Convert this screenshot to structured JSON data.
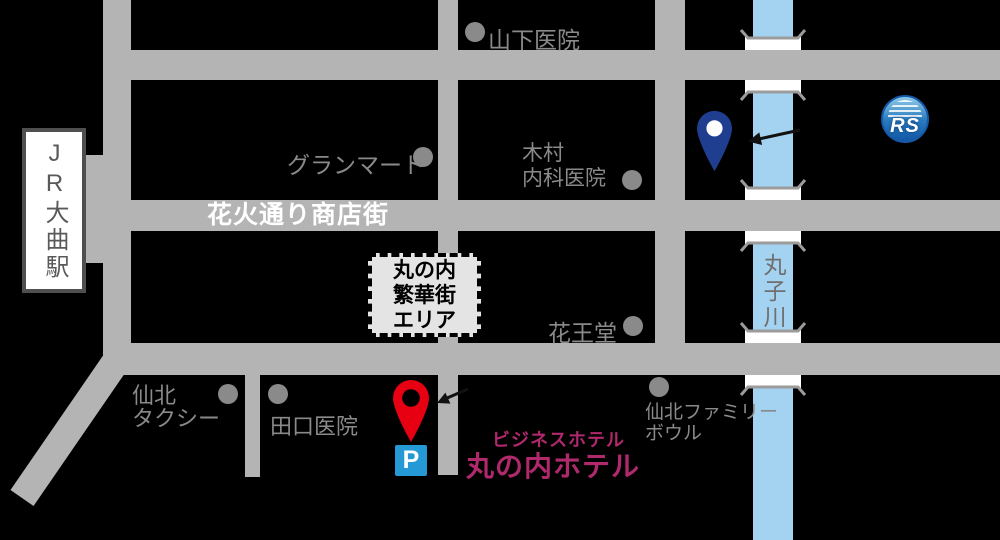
{
  "station": {
    "label": "JR大曲駅"
  },
  "streets": {
    "hanabi": "花火通り商店街"
  },
  "river": {
    "label": "丸子川"
  },
  "area_box": {
    "line1": "丸の内",
    "line2": "繁華街",
    "line3": "エリア"
  },
  "pois": {
    "yamashita": {
      "label": "山下医院"
    },
    "granmart": {
      "label": "グランマート"
    },
    "kimura": {
      "line1": "木村",
      "line2": "内科医院"
    },
    "kaodo": {
      "label": "花王堂"
    },
    "taxi": {
      "line1": "仙北",
      "line2": "タクシー"
    },
    "taguchi": {
      "label": "田口医院"
    },
    "bowl": {
      "line1": "仙北ファミリー",
      "line2": "ボウル"
    }
  },
  "hotel": {
    "subtitle": "ビジネスホテル",
    "name": "丸の内ホテル"
  },
  "parking": {
    "label": "P"
  },
  "logo": {
    "text": "RS"
  },
  "colors": {
    "background": "#000000",
    "road": "#b4b4b4",
    "river": "#a3d3f1",
    "poi_gray": "#8a8a8a",
    "street_label": "#ffffff",
    "hotel_magenta": "#b0296d",
    "pin_red": "#e60012",
    "pin_blue": "#1f3e8f",
    "parking_blue": "#2599d6",
    "logo_blue": "#1659a8"
  }
}
